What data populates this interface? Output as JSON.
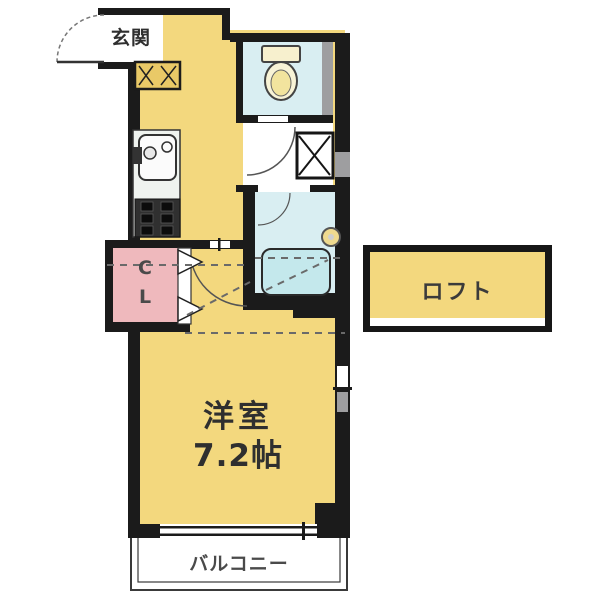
{
  "floor_plan": {
    "rooms": {
      "entrance": {
        "label": "玄関"
      },
      "closet": {
        "chars": [
          "C",
          "L"
        ]
      },
      "loft": {
        "label": "ロフト"
      },
      "main_room": {
        "name": "洋室",
        "size": "7.2帖"
      },
      "balcony": {
        "label": "バルコニー"
      }
    },
    "colors": {
      "room_yellow": "#F3D87E",
      "wet_area_blue": "#D9EEF2",
      "bathtub_blue": "#C4E8EC",
      "closet_pink": "#EFB9BD",
      "wall_black": "#1B1B1B",
      "fixture_gray": "#9E9EA0",
      "background": "#FFFFFF"
    },
    "fixtures": [
      "toilet-icon",
      "sink-icon",
      "stove-icon",
      "bathtub-icon",
      "washing-machine-icon",
      "shoe-cabinet-icon",
      "door-swing-icon",
      "folding-door-icon",
      "window-icon",
      "bath-faucet-icon"
    ]
  }
}
